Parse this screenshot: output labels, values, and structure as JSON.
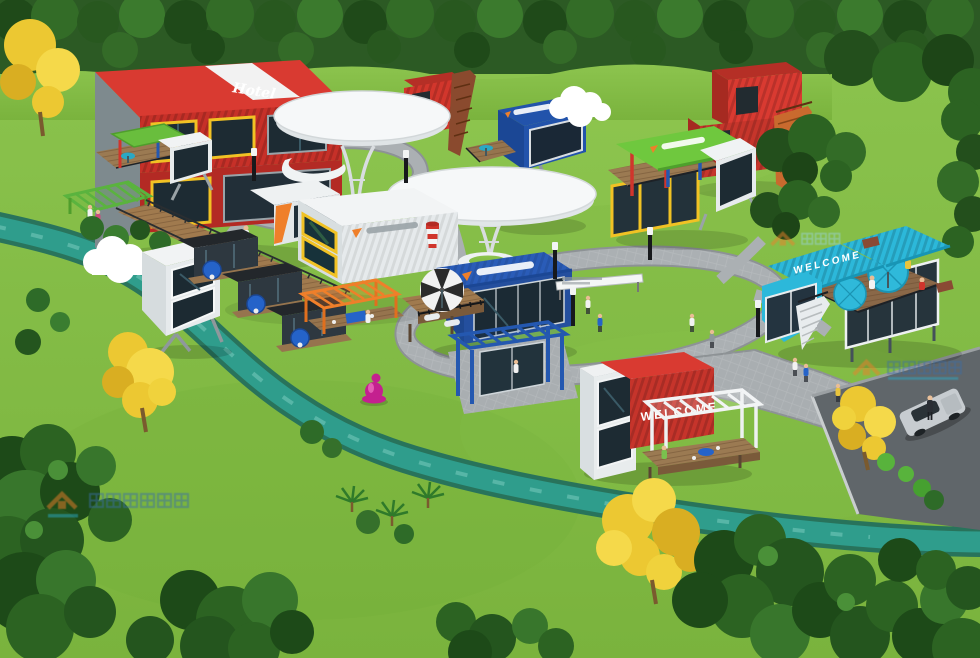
{
  "meta": {
    "title": "Container Park Aerial 3D Rendering",
    "width": 980,
    "height": 658
  },
  "texts": {
    "hotel_roof_script": "Hotel",
    "teal_roof_welcome": "WELCOME",
    "red_container_welcome": "WELCOME"
  },
  "colors": {
    "grass": "#7fb93f",
    "grass_light": "#96cd55",
    "forest": "#2c5a24",
    "water": "#2f9d8c",
    "water_bank": "#1f6b5e",
    "path": "#a9aeb1",
    "asphalt": "#60666a",
    "red_container": "#d93a31",
    "red_container_face": "#c6342b",
    "blue_container": "#2a5cb8",
    "dark_blue_pod": "#2253ab",
    "teal_building": "#2cb8da",
    "green_roof": "#6fc83e",
    "orange_accent": "#ef7f2a",
    "yellow_frame": "#f1c224",
    "wood_deck": "#9b7a52",
    "white_structure": "#f2f4f5",
    "glass": "#1d2b33",
    "umbrella_teal": "#2fb9da",
    "umbrella_blue": "#2563c9",
    "car_body": "#c7ccd0",
    "pink_sculpture": "#c4208f",
    "yellow_tree": "#ecc832"
  },
  "buildings": [
    {
      "id": "red-hotel",
      "label": "Red container hotel with white roof stripe and script sign",
      "color": "#d93a31"
    },
    {
      "id": "red-stair-tower-a",
      "label": "Red container tower with external stairs (center)",
      "color": "#d2362c"
    },
    {
      "id": "mushroom-canopy-1",
      "label": "White mushroom canopy structure",
      "color": "#f4f6f7"
    },
    {
      "id": "mushroom-canopy-2",
      "label": "White mushroom canopy structure (front)",
      "color": "#f5f7f8"
    },
    {
      "id": "dark-blue-pod",
      "label": "Dark blue cantilevered pod with cloud sculpture and deck",
      "color": "#2253ab"
    },
    {
      "id": "red-stair-tower-b",
      "label": "Red container stack with orange staircase (top right)",
      "color": "#d83a30"
    },
    {
      "id": "green-roof-lounge",
      "label": "Green-roof rooftop lounge with red and blue frames and white pod",
      "color": "#6fc83e"
    },
    {
      "id": "teal-welcome-building",
      "label": "Teal WELCOME building with rooftop umbrella terrace and stairs",
      "color": "#2cb8da"
    },
    {
      "id": "white-container-suites",
      "label": "White container suites with yellow angled window frames",
      "color": "#f2f4f5"
    },
    {
      "id": "cabin-row",
      "label": "Row of dark cabins with blue patio umbrellas",
      "color": "#2e3840"
    },
    {
      "id": "orange-pergola",
      "label": "Orange slat pergola lounge",
      "color": "#ef7f2a"
    },
    {
      "id": "green-pergola",
      "label": "Green slat pergola",
      "color": "#5ab33e"
    },
    {
      "id": "left-white-pods",
      "label": "White angled pods with cloud sculpture",
      "color": "#f1f3f4"
    },
    {
      "id": "blue-restaurant",
      "label": "Blue container restaurant with striped umbrella deck and blue pergola",
      "color": "#2a5cb8"
    },
    {
      "id": "red-welcome-building",
      "label": "Red WELCOME container with white pergola deck",
      "color": "#c6342b"
    }
  ],
  "objects": [
    {
      "id": "stream",
      "label": "Winding teal stream"
    },
    {
      "id": "boardwalk",
      "label": "Wooden boardwalk with railings"
    },
    {
      "id": "path-loops",
      "label": "Gray paver walking loops"
    },
    {
      "id": "parking-lot",
      "label": "Asphalt parking lot"
    },
    {
      "id": "silver-car",
      "label": "Silver parked car"
    },
    {
      "id": "pink-sculpture",
      "label": "Pink sitting-figure lawn sculpture"
    },
    {
      "id": "direction-sign",
      "label": "White wayfinding sign"
    },
    {
      "id": "bollard-lights",
      "label": "Black and white bollard path lights"
    },
    {
      "id": "people",
      "label": "Small pedestrian figures"
    }
  ],
  "watermark": {
    "logo": "orange-roof-house-logo",
    "style": "semi-transparent CJK developer watermark",
    "count": 3
  }
}
